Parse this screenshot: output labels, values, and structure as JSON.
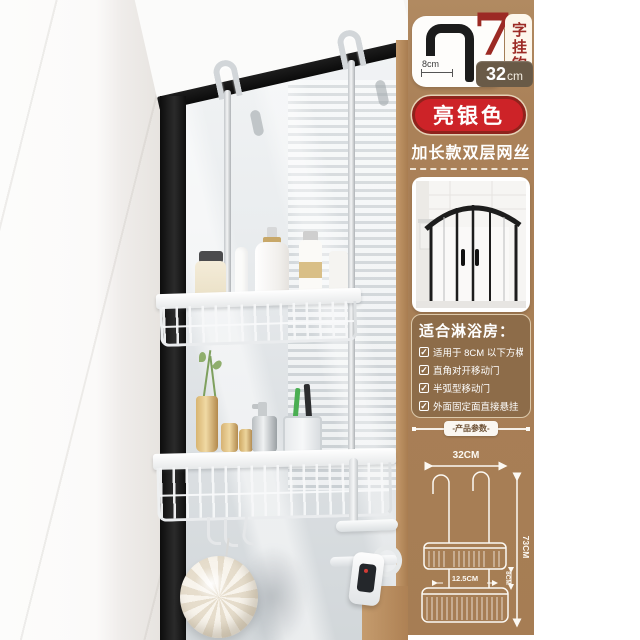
{
  "colors": {
    "accent_red": "#cd2328",
    "sidebar_brown": "#aa8158",
    "panel_brown": "#8d6c49",
    "length_badge_taupe": "#695a47",
    "frame_black": "#141414"
  },
  "sidebar": {
    "hook_spec": {
      "number": "7",
      "number_suffix": "字挂钩",
      "hook_width": "8cm",
      "bar_length_value": "32",
      "bar_length_unit": "cm"
    },
    "color_badge": "亮银色",
    "subtitle": "加长款双层网丝",
    "check_icon": "✓",
    "suitable": {
      "title": "适合淋浴房：",
      "items": [
        "适用于 8CM 以下方横梁",
        "直角对开移动门",
        "半弧型移动门",
        "外面固定面直接悬挂"
      ]
    },
    "params_label": "-产品参数-",
    "diagram": {
      "width": "32CM",
      "height": "73CM",
      "tier_gap": "8CM",
      "basket_depth": "12.5CM"
    }
  }
}
